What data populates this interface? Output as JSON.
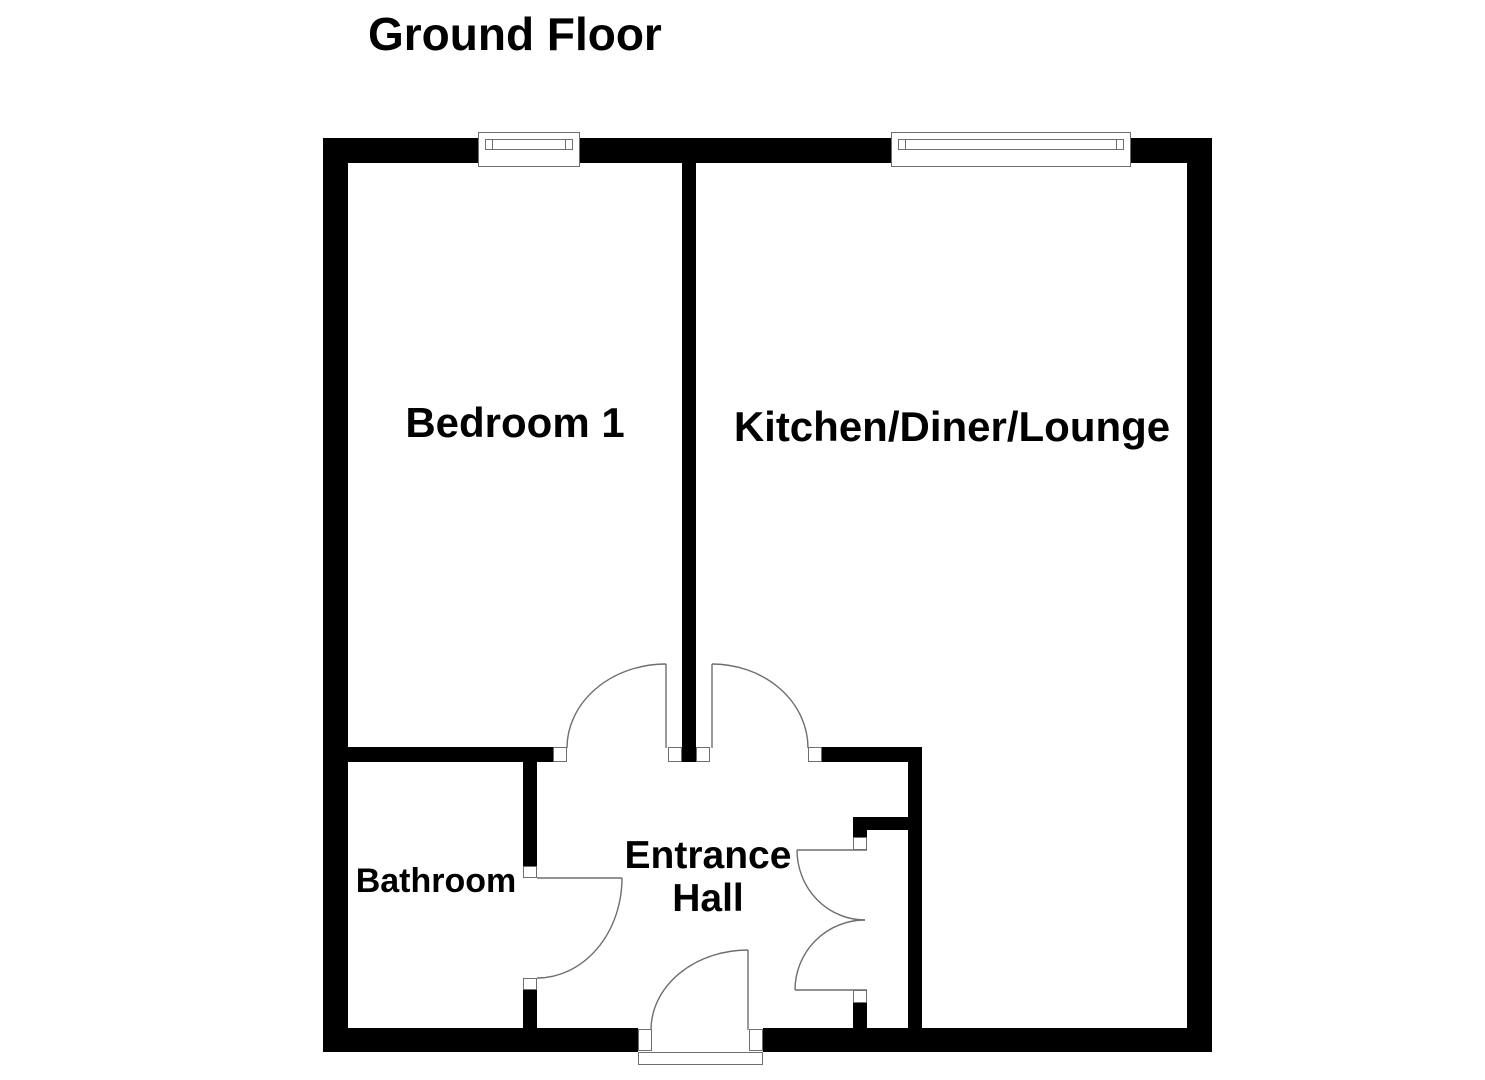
{
  "title": "Ground Floor",
  "rooms": [
    {
      "id": "bedroom-1",
      "label": "Bedroom 1"
    },
    {
      "id": "kitchen-diner-lounge",
      "label": "Kitchen/Diner/Lounge"
    },
    {
      "id": "bathroom",
      "label": "Bathroom"
    },
    {
      "id": "entrance-hall",
      "label": "Entrance Hall",
      "lines": [
        "Entrance",
        "Hall"
      ]
    }
  ],
  "colors": {
    "wall": "#000000",
    "line": "#6e6e6e",
    "bg": "#ffffff",
    "text": "#000000"
  }
}
